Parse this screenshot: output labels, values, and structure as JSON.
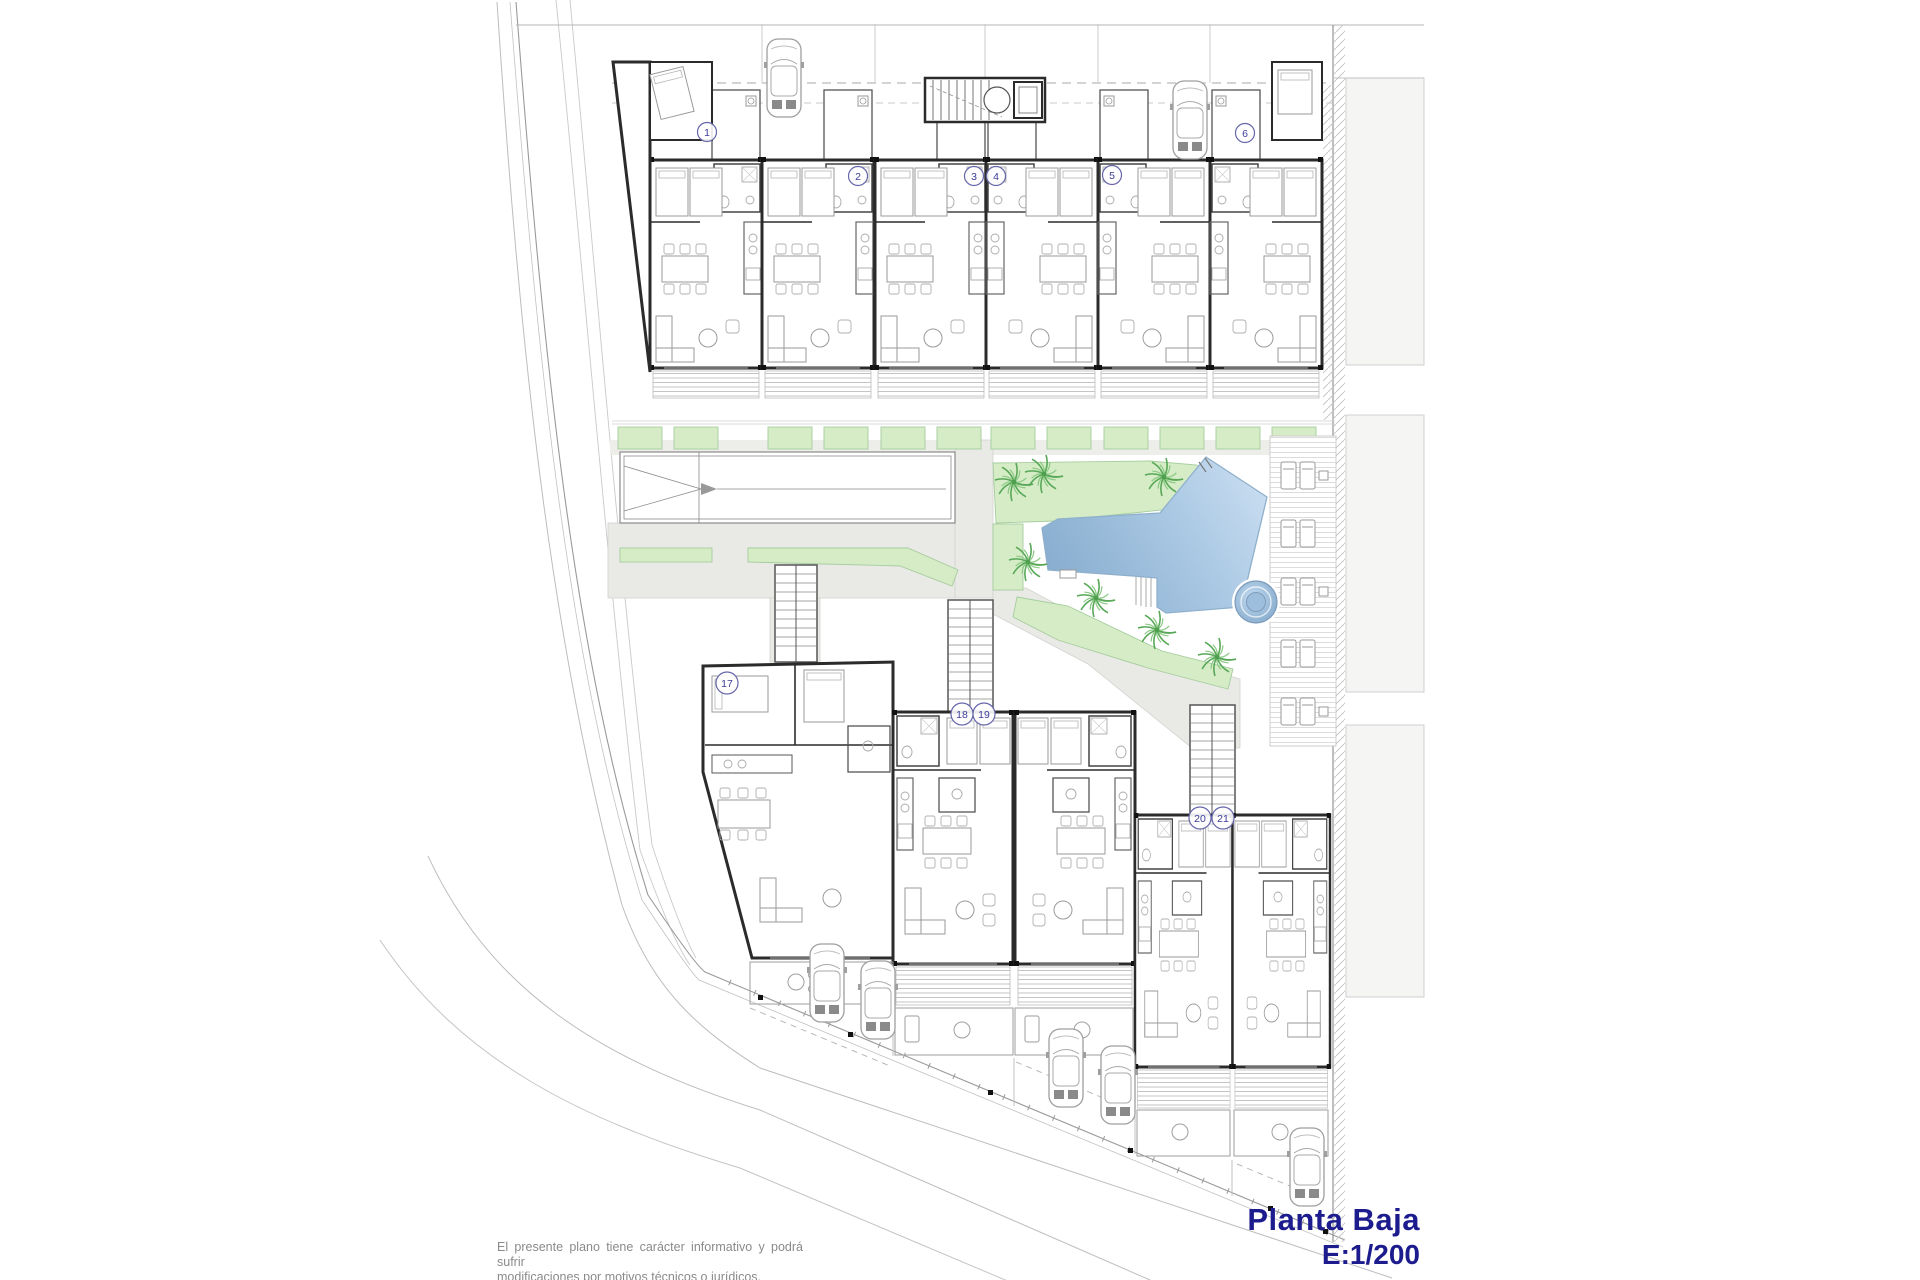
{
  "document": {
    "title": "Planta Baja",
    "scale_label": "E:1/200",
    "disclaimer": [
      "El presente plano tiene carácter informativo y podrá sufrir",
      "modificaciones por motivos técnicos o jurídicos."
    ]
  },
  "colors": {
    "title_text": "#1c1c8e",
    "disclaimer_text": "#8a8a8a",
    "wall": "#2b2b2b",
    "furniture": "#b0b0b0",
    "path_gray": "#e9e9e6",
    "landscape_green": "#d6ecc7",
    "landscape_stroke": "#a5cd9d",
    "tree_green": "#58a858",
    "pool_dark": "#85abcd",
    "pool_light": "#cadef1",
    "pool_edge": "#8fb0cc",
    "badge_blue": "#3c3c9a",
    "road_gray": "#b8b8b8",
    "neighbor_gray": "#f5f5f3"
  },
  "plan": {
    "unit_badges": [
      {
        "label": "1",
        "x": 707,
        "y": 132
      },
      {
        "label": "2",
        "x": 858,
        "y": 176
      },
      {
        "label": "3",
        "x": 974,
        "y": 176
      },
      {
        "label": "4",
        "x": 996,
        "y": 176
      },
      {
        "label": "5",
        "x": 1112,
        "y": 175
      },
      {
        "label": "6",
        "x": 1245,
        "y": 133
      },
      {
        "label": "17",
        "x": 727,
        "y": 683
      },
      {
        "label": "18",
        "x": 962,
        "y": 714
      },
      {
        "label": "19",
        "x": 984,
        "y": 714
      },
      {
        "label": "20",
        "x": 1200,
        "y": 818
      },
      {
        "label": "21",
        "x": 1223,
        "y": 818
      }
    ],
    "trees": [
      {
        "x": 1014,
        "y": 482
      },
      {
        "x": 1044,
        "y": 474
      },
      {
        "x": 1164,
        "y": 477
      },
      {
        "x": 1028,
        "y": 562
      },
      {
        "x": 1096,
        "y": 598
      },
      {
        "x": 1157,
        "y": 630
      },
      {
        "x": 1217,
        "y": 657
      }
    ],
    "cars": [
      {
        "x": 784,
        "y": 78
      },
      {
        "x": 1190,
        "y": 120
      },
      {
        "x": 827,
        "y": 983
      },
      {
        "x": 878,
        "y": 1000
      },
      {
        "x": 1066,
        "y": 1068
      },
      {
        "x": 1118,
        "y": 1085
      },
      {
        "x": 1307,
        "y": 1167
      }
    ],
    "sun_lounger_rows": [
      462,
      520,
      578,
      640,
      698
    ]
  }
}
